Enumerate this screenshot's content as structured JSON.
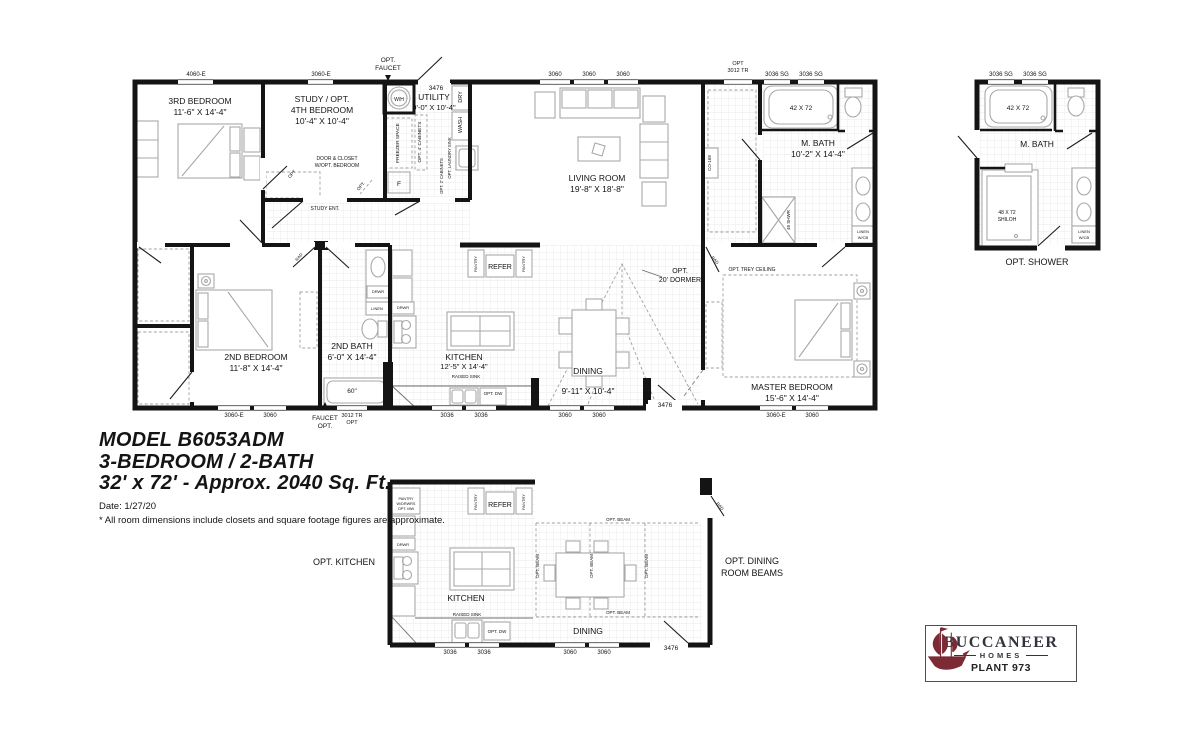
{
  "title_block": {
    "model": "MODEL B6053ADM",
    "layout": "3-BEDROOM / 2-BATH",
    "size": "32' x 72' - Approx. 2040 Sq. Ft.",
    "date": "Date: 1/27/20",
    "disclaimer": "* All room dimensions include closets and square footage figures are approximate."
  },
  "logo": {
    "brand": "BUCCANEER",
    "division": "HOMES",
    "plant": "PLANT 973"
  },
  "colors": {
    "wall": "#141414",
    "furniture": "#a8a8a8",
    "tile": "#e4e4e4",
    "dash": "#a0a0a0",
    "brand_red": "#7c2b35"
  },
  "annotations": [
    {
      "id": "win-label-4060e",
      "t": "4060-E",
      "x": 196,
      "y": 76,
      "s": 6
    },
    {
      "id": "win-label-3060e-top",
      "t": "3060-E",
      "x": 321,
      "y": 76,
      "s": 6
    },
    {
      "id": "opt-faucet-top-line1",
      "t": "OPT.",
      "x": 388,
      "y": 62,
      "s": 6.5
    },
    {
      "id": "opt-faucet-top-line2",
      "t": "FAUCET",
      "x": 388,
      "y": 70,
      "s": 6.5
    },
    {
      "id": "door-label-3476-top",
      "t": "3476",
      "x": 436,
      "y": 90,
      "s": 6.5
    },
    {
      "id": "win-label-3060-lr1",
      "t": "3060",
      "x": 555,
      "y": 76,
      "s": 6
    },
    {
      "id": "win-label-3060-lr2",
      "t": "3060",
      "x": 589,
      "y": 76,
      "s": 6
    },
    {
      "id": "win-label-3060-lr3",
      "t": "3060",
      "x": 623,
      "y": 76,
      "s": 6
    },
    {
      "id": "win-label-3012tr-top-line1",
      "t": "OPT",
      "x": 738,
      "y": 65,
      "s": 5.5
    },
    {
      "id": "win-label-3012tr-top-line2",
      "t": "3012 TR",
      "x": 738,
      "y": 72,
      "s": 5.5
    },
    {
      "id": "win-label-3036sg-1",
      "t": "3036 SG",
      "x": 777,
      "y": 76,
      "s": 6
    },
    {
      "id": "win-label-3036sg-2",
      "t": "3036 SG",
      "x": 811,
      "y": 76,
      "s": 6
    },
    {
      "id": "room-bedroom3-name",
      "t": "3RD BEDROOM",
      "x": 200,
      "y": 104,
      "s": 8.5
    },
    {
      "id": "room-bedroom3-dims",
      "t": "11'-6\" X 14'-4\"",
      "x": 200,
      "y": 115,
      "s": 8.5
    },
    {
      "id": "room-study-name1",
      "t": "STUDY / OPT.",
      "x": 322,
      "y": 102,
      "s": 8.5
    },
    {
      "id": "room-study-name2",
      "t": "4TH BEDROOM",
      "x": 322,
      "y": 113,
      "s": 8.5
    },
    {
      "id": "room-study-dims",
      "t": "10'-4\" X 10'-4\"",
      "x": 322,
      "y": 124,
      "s": 8.5
    },
    {
      "id": "water-heater-label",
      "t": "W/H",
      "x": 399,
      "y": 101,
      "s": 5
    },
    {
      "id": "room-utility-name",
      "t": "UTILITY",
      "x": 434,
      "y": 100,
      "s": 8.5
    },
    {
      "id": "room-utility-dims",
      "t": "9'-0\" X 10'-4\"",
      "x": 434,
      "y": 110,
      "s": 7.5
    },
    {
      "id": "dry-label",
      "t": "DRY",
      "x": 462,
      "y": 97,
      "s": 5.5,
      "r": -90
    },
    {
      "id": "wash-label",
      "t": "WASH",
      "x": 462,
      "y": 125,
      "s": 5.5,
      "r": -90
    },
    {
      "id": "freezer-space-label",
      "t": "FREEZER SPACE",
      "x": 399,
      "y": 143,
      "s": 4.8,
      "r": -90
    },
    {
      "id": "opt-4-cabinets-label",
      "t": "OPT. 4' CABINETS",
      "x": 421,
      "y": 142,
      "s": 4.8,
      "r": -90
    },
    {
      "id": "opt-laundry-sink-label",
      "t": "OPT. LAUNDRY SINK",
      "x": 451,
      "y": 158,
      "s": 4.2,
      "r": -90
    },
    {
      "id": "opt-2-cabinets-label",
      "t": "OPT. 2' CABINETS",
      "x": 443,
      "y": 176,
      "s": 4.2,
      "r": -90
    },
    {
      "id": "furnace-label",
      "t": "F",
      "x": 399,
      "y": 186,
      "s": 6.5
    },
    {
      "id": "door-closet-note-line1",
      "t": "DOOR & CLOSET",
      "x": 337,
      "y": 160,
      "s": 5
    },
    {
      "id": "door-closet-note-line2",
      "t": "W/OPT. BEDROOM",
      "x": 337,
      "y": 167,
      "s": 5
    },
    {
      "id": "study-ent-label",
      "t": "STUDY ENT.",
      "x": 325,
      "y": 210,
      "s": 5
    },
    {
      "id": "opt-door-study-label",
      "t": "OPT",
      "x": 293,
      "y": 175,
      "s": 4.5,
      "r": -50
    },
    {
      "id": "opt-door-hall-label",
      "t": "OPT.",
      "x": 362,
      "y": 187,
      "s": 4.5,
      "r": -50
    },
    {
      "id": "room-living-name",
      "t": "LIVING ROOM",
      "x": 597,
      "y": 181,
      "s": 8.5
    },
    {
      "id": "room-living-dims",
      "t": "19'-8\" X 18'-8\"",
      "x": 597,
      "y": 192,
      "s": 8.5
    },
    {
      "id": "co168-label",
      "t": "CO-168",
      "x": 711,
      "y": 163,
      "s": 4.5,
      "r": -90
    },
    {
      "id": "room-mbath-name",
      "t": "M. BATH",
      "x": 818,
      "y": 146,
      "s": 8.5
    },
    {
      "id": "room-mbath-dims",
      "t": "10'-2\" X 14'-4\"",
      "x": 818,
      "y": 157,
      "s": 8.5
    },
    {
      "id": "mbath-tub-label",
      "t": "42 X 72",
      "x": 801,
      "y": 110,
      "s": 6.5
    },
    {
      "id": "mbath-shower-label",
      "t": "48 SHWR",
      "x": 790,
      "y": 220,
      "s": 4.5,
      "r": -90
    },
    {
      "id": "mbath-linen-line1",
      "t": "LINEN",
      "x": 863,
      "y": 233,
      "s": 4
    },
    {
      "id": "mbath-linen-line2",
      "t": "W/CB",
      "x": 863,
      "y": 239,
      "s": 4
    },
    {
      "id": "opt-trey-ceiling-label",
      "t": "OPT. TREY CEILING",
      "x": 752,
      "y": 271,
      "s": 5
    },
    {
      "id": "room-master-name",
      "t": "MASTER BEDROOM",
      "x": 792,
      "y": 390,
      "s": 8.5
    },
    {
      "id": "room-master-dims",
      "t": "15'-6\" X 14'-4\"",
      "x": 792,
      "y": 401,
      "s": 8.5
    },
    {
      "id": "room-bedroom2-name",
      "t": "2ND BEDROOM",
      "x": 256,
      "y": 360,
      "s": 8.5
    },
    {
      "id": "room-bedroom2-dims",
      "t": "11'-8\" X 14'-4\"",
      "x": 256,
      "y": 371,
      "s": 8.5
    },
    {
      "id": "room-bath2-name",
      "t": "2ND BATH",
      "x": 352,
      "y": 349,
      "s": 8.5
    },
    {
      "id": "room-bath2-dims",
      "t": "6'-0\" X 14'-4\"",
      "x": 352,
      "y": 360,
      "s": 8.5
    },
    {
      "id": "bath2-tub-label",
      "t": "60\"",
      "x": 352,
      "y": 393,
      "s": 6.5
    },
    {
      "id": "bath2-drwr-label",
      "t": "DRWR",
      "x": 378,
      "y": 293,
      "s": 4
    },
    {
      "id": "bath2-linen-label",
      "t": "LINEN",
      "x": 377,
      "y": 310,
      "s": 4
    },
    {
      "id": "kitchen-drwr-label",
      "t": "DRWR",
      "x": 403,
      "y": 309,
      "s": 4
    },
    {
      "id": "refer-label",
      "t": "REFER",
      "x": 500,
      "y": 269,
      "s": 7
    },
    {
      "id": "pantry-left-label",
      "t": "PANTRY",
      "x": 477,
      "y": 264,
      "s": 4,
      "r": -90
    },
    {
      "id": "pantry-right-label",
      "t": "PANTRY",
      "x": 525,
      "y": 264,
      "s": 4,
      "r": -90
    },
    {
      "id": "room-kitchen-name",
      "t": "KITCHEN",
      "x": 464,
      "y": 360,
      "s": 8.5
    },
    {
      "id": "room-kitchen-dims",
      "t": "12'-5\" X 14'-4\"",
      "x": 464,
      "y": 369,
      "s": 7.5
    },
    {
      "id": "raised-sink-label",
      "t": "RAISED SINK",
      "x": 466,
      "y": 378,
      "s": 4.5
    },
    {
      "id": "opt-dw-label",
      "t": "OPT. DW",
      "x": 493,
      "y": 395,
      "s": 4.5
    },
    {
      "id": "room-dining-name",
      "t": "DINING",
      "x": 588,
      "y": 374,
      "s": 8.5
    },
    {
      "id": "room-dining-dims",
      "t": "9'-11\" X 10'-4\"",
      "x": 588,
      "y": 394,
      "s": 8.5
    },
    {
      "id": "opt-dormer-line1",
      "t": "OPT.",
      "x": 680,
      "y": 273,
      "s": 7
    },
    {
      "id": "opt-dormer-line2",
      "t": "20' DORMER",
      "x": 680,
      "y": 282,
      "s": 7
    },
    {
      "id": "rad-door-bed2-label",
      "t": "RAD",
      "x": 300,
      "y": 258,
      "s": 4.2,
      "r": -50
    },
    {
      "id": "rad-door-master-label",
      "t": "RAD",
      "x": 714,
      "y": 261,
      "s": 4.2,
      "r": 50
    },
    {
      "id": "win-label-3060e-bed2",
      "t": "3060-E",
      "x": 234,
      "y": 417,
      "s": 6
    },
    {
      "id": "win-label-3060-bed2",
      "t": "3060",
      "x": 270,
      "y": 417,
      "s": 6
    },
    {
      "id": "faucet-opt-bottom-line1",
      "t": "FAUCET",
      "x": 325,
      "y": 420,
      "s": 6.5
    },
    {
      "id": "faucet-opt-bottom-line2",
      "t": "OPT.",
      "x": 325,
      "y": 428,
      "s": 6.5
    },
    {
      "id": "win-label-3012tr-b-line1",
      "t": "3012 TR",
      "x": 352,
      "y": 417,
      "s": 5.5
    },
    {
      "id": "win-label-3012tr-b-line2",
      "t": "OPT",
      "x": 352,
      "y": 424,
      "s": 5.5
    },
    {
      "id": "win-label-3036-k1",
      "t": "3036",
      "x": 447,
      "y": 417,
      "s": 6
    },
    {
      "id": "win-label-3036-k2",
      "t": "3036",
      "x": 481,
      "y": 417,
      "s": 6
    },
    {
      "id": "win-label-3060-d1",
      "t": "3060",
      "x": 565,
      "y": 417,
      "s": 6
    },
    {
      "id": "win-label-3060-d2",
      "t": "3060",
      "x": 599,
      "y": 417,
      "s": 6
    },
    {
      "id": "door-label-3476-bottom",
      "t": "3476",
      "x": 665,
      "y": 407,
      "s": 6.5
    },
    {
      "id": "win-label-3060e-master",
      "t": "3060-E",
      "x": 776,
      "y": 417,
      "s": 6
    },
    {
      "id": "win-label-3060-master",
      "t": "3060",
      "x": 812,
      "y": 417,
      "s": 6
    },
    {
      "id": "win-label-3036sg-opt1",
      "t": "3036 SG",
      "x": 1001,
      "y": 76,
      "s": 6
    },
    {
      "id": "win-label-3036sg-opt2",
      "t": "3036 SG",
      "x": 1035,
      "y": 76,
      "s": 6
    },
    {
      "id": "mbath-opt-tub-label",
      "t": "42 X 72",
      "x": 1018,
      "y": 110,
      "s": 6.5
    },
    {
      "id": "room-mbath-opt-name",
      "t": "M. BATH",
      "x": 1037,
      "y": 147,
      "s": 8.5
    },
    {
      "id": "shiloh-shower-line1",
      "t": "48 X 72",
      "x": 1007,
      "y": 214,
      "s": 5
    },
    {
      "id": "shiloh-shower-line2",
      "t": "SHILOH",
      "x": 1007,
      "y": 221,
      "s": 5
    },
    {
      "id": "mbath-opt-linen-line1",
      "t": "LINEN",
      "x": 1084,
      "y": 233,
      "s": 4
    },
    {
      "id": "mbath-opt-linen-line2",
      "t": "W/CB",
      "x": 1084,
      "y": 239,
      "s": 4
    },
    {
      "id": "opt-shower-caption",
      "t": "OPT. SHOWER",
      "x": 1037,
      "y": 265,
      "s": 9
    },
    {
      "id": "pantry-drwrs-line1",
      "t": "PANTRY",
      "x": 406,
      "y": 500,
      "s": 3.8
    },
    {
      "id": "pantry-drwrs-line2",
      "t": "W/DRWRS",
      "x": 406,
      "y": 505,
      "s": 3.8
    },
    {
      "id": "pantry-drwrs-line3",
      "t": "OPT. MW",
      "x": 406,
      "y": 510,
      "s": 3.8
    },
    {
      "id": "pantry-opt-left-label",
      "t": "PANTRY",
      "x": 477,
      "y": 502,
      "s": 4,
      "r": -90
    },
    {
      "id": "pantry-opt-right-label",
      "t": "PANTRY",
      "x": 525,
      "y": 502,
      "s": 4,
      "r": -90
    },
    {
      "id": "refer-opt-label",
      "t": "REFER",
      "x": 500,
      "y": 507,
      "s": 7
    },
    {
      "id": "kitchen-opt-drwr-label",
      "t": "DRWR",
      "x": 403,
      "y": 546,
      "s": 4
    },
    {
      "id": "room-kitchen-opt-name",
      "t": "KITCHEN",
      "x": 466,
      "y": 601,
      "s": 8.5
    },
    {
      "id": "raised-sink-opt-label",
      "t": "RAISED SINK",
      "x": 467,
      "y": 616,
      "s": 4.5
    },
    {
      "id": "opt-dw-opt-label",
      "t": "OPT. DW",
      "x": 497,
      "y": 633,
      "s": 4.5
    },
    {
      "id": "opt-beam-v1-label",
      "t": "OPT. BEAM",
      "x": 539,
      "y": 566,
      "s": 4.5,
      "r": -90
    },
    {
      "id": "opt-beam-v2-label",
      "t": "OPT. BEAM",
      "x": 593,
      "y": 566,
      "s": 4.5,
      "r": -90
    },
    {
      "id": "opt-beam-v3-label",
      "t": "OPT. BEAM",
      "x": 648,
      "y": 566,
      "s": 4.5,
      "r": -90
    },
    {
      "id": "opt-beam-h1-label",
      "t": "OPT. BEAM",
      "x": 618,
      "y": 521,
      "s": 4.5
    },
    {
      "id": "opt-beam-h2-label",
      "t": "OPT. BEAM",
      "x": 618,
      "y": 614,
      "s": 4.5
    },
    {
      "id": "room-dining-opt-name",
      "t": "DINING",
      "x": 588,
      "y": 634,
      "s": 8.5
    },
    {
      "id": "door-label-3476-opt",
      "t": "3476",
      "x": 671,
      "y": 650,
      "s": 6.5
    },
    {
      "id": "rad-door-opt-label",
      "t": "RAD",
      "x": 719,
      "y": 507,
      "s": 4.2,
      "r": 50
    },
    {
      "id": "opt-kitchen-caption",
      "t": "OPT. KITCHEN",
      "x": 344,
      "y": 565,
      "s": 9
    },
    {
      "id": "opt-dining-caption-line1",
      "t": "OPT. DINING",
      "x": 752,
      "y": 564,
      "s": 9
    },
    {
      "id": "opt-dining-caption-line2",
      "t": "ROOM BEAMS",
      "x": 752,
      "y": 576,
      "s": 9
    },
    {
      "id": "win-label-3036-opt1",
      "t": "3036",
      "x": 450,
      "y": 654,
      "s": 6
    },
    {
      "id": "win-label-3036-opt2",
      "t": "3036",
      "x": 484,
      "y": 654,
      "s": 6
    },
    {
      "id": "win-label-3060-opt1",
      "t": "3060",
      "x": 570,
      "y": 654,
      "s": 6
    },
    {
      "id": "win-label-3060-opt2",
      "t": "3060",
      "x": 604,
      "y": 654,
      "s": 6
    }
  ]
}
